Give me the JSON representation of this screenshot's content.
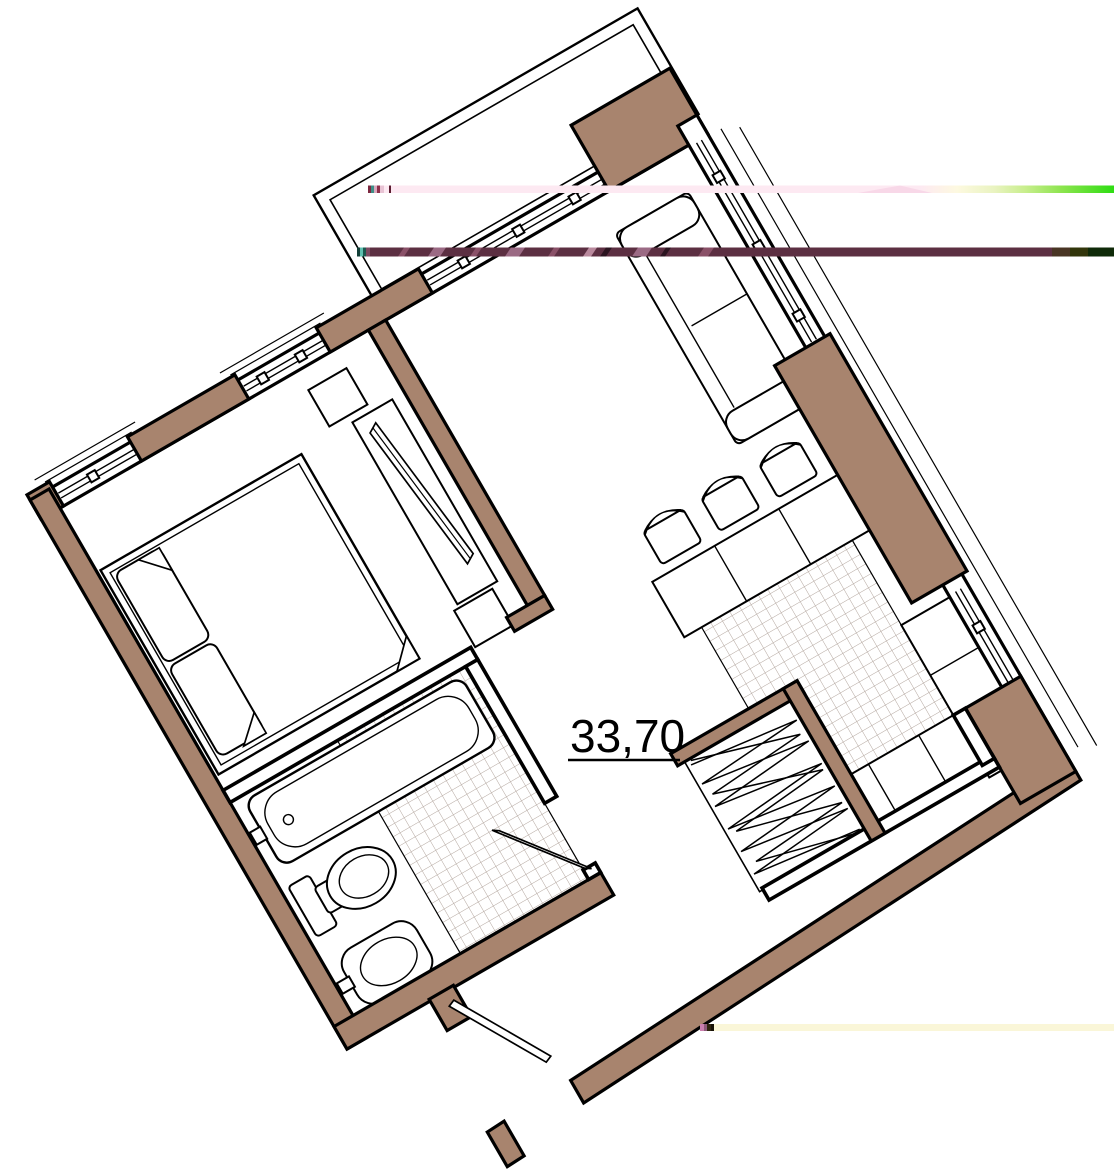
{
  "plan": {
    "type": "apartment-floor-plan",
    "area_label": "33,70"
  },
  "colors": {
    "background": "#ffffff",
    "wall_fill": "#a8846e",
    "wall_outline": "#000000",
    "partition_fill": "#ffffff",
    "furniture_line": "#000000",
    "tile_line": "#b3a69e",
    "glitch_pink": "#fde9f2",
    "glitch_pale_yellow": "#fdf9e0",
    "glitch_lime": "#c9ee8e",
    "glitch_green": "#2edd13",
    "glitch_maroon": "#5c2f42",
    "glitch_maroon_light": "#9b6a84",
    "glitch_brown": "#493524",
    "glitch_olive": "#32360b",
    "glitch_dark_green": "#0f2a08",
    "glitch_cream": "#faf6d8"
  },
  "features": [
    "balcony",
    "bedroom-bed",
    "pillows",
    "wardrobe-closet",
    "dresser",
    "sofa",
    "dining-table",
    "chairs",
    "kitchen-counters",
    "kitchen-tile-floor",
    "bathroom",
    "bathtub",
    "toilet",
    "sink",
    "bathroom-tile-floor",
    "entry-door",
    "bathroom-door",
    "windows",
    "wall-piers"
  ],
  "glitch_lines": [
    {
      "name": "glitch-line-top",
      "appearance": "pale-pink fading to bright green"
    },
    {
      "name": "glitch-line-middle",
      "appearance": "dark maroon ending in olive and dark green"
    },
    {
      "name": "glitch-line-bottom",
      "appearance": "pale cream yellow"
    }
  ]
}
